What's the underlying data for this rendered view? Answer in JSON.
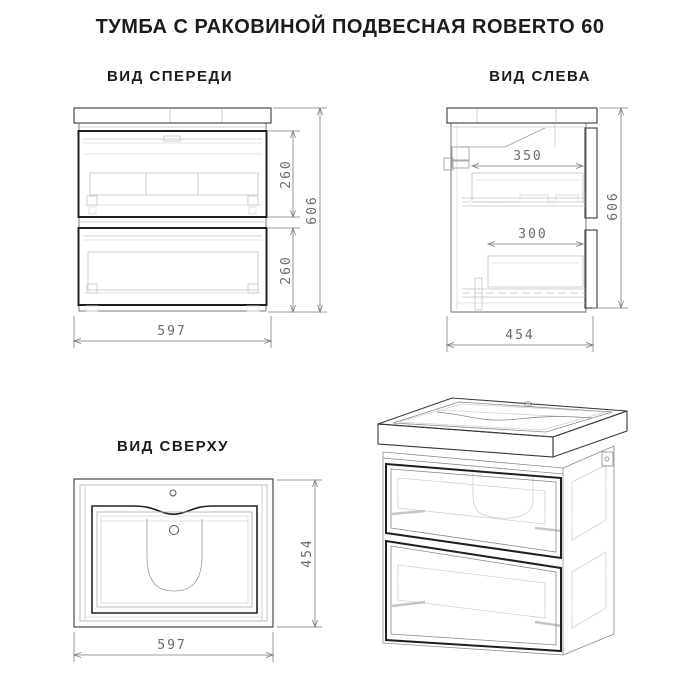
{
  "title": "ТУМБА С РАКОВИНОЙ ПОДВЕСНАЯ ROBERTO 60",
  "views": {
    "front": {
      "label": "ВИД СПЕРЕДИ",
      "dims": {
        "top_drawer_height": "260",
        "bottom_drawer_height": "260",
        "total_height": "606",
        "width": "597"
      }
    },
    "left": {
      "label": "ВИД СЛЕВА",
      "dims": {
        "top_drawer_depth": "350",
        "bottom_drawer_depth": "300",
        "total_height": "606",
        "depth": "454"
      }
    },
    "top": {
      "label": "ВИД СВЕРХУ",
      "dims": {
        "depth": "454",
        "width": "597"
      }
    }
  },
  "colors": {
    "background": "#ffffff",
    "outline": "#3a3a3a",
    "drawer_border": "#1f1f1f",
    "internal_detail": "#c4c4c4",
    "dimension_line": "#7a7a7a",
    "dimension_text": "#6b6b6b",
    "label_text": "#1c1c1c"
  }
}
